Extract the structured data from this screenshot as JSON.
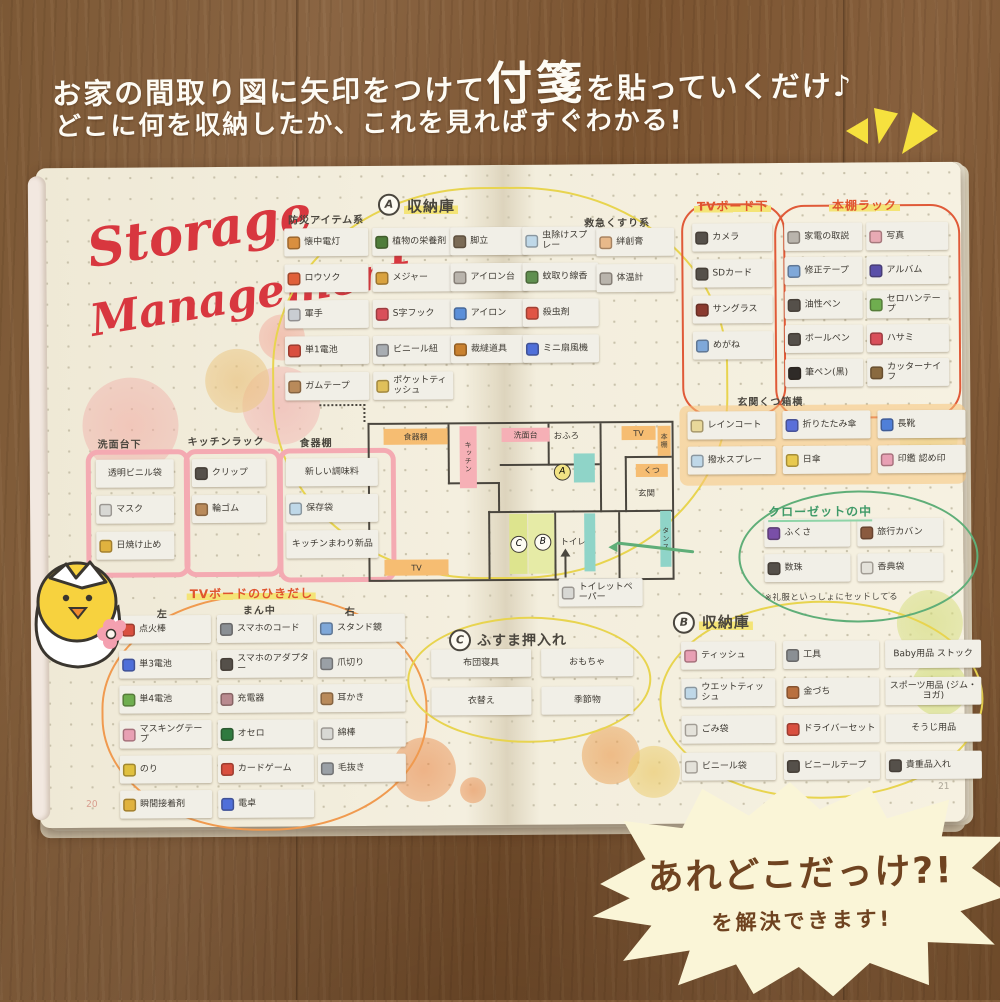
{
  "intro": {
    "line1_pre": "お家の間取り図に矢印をつけて",
    "line1_big": "付箋",
    "line1_post": "を貼っていくだけ♪",
    "line2": "どこに何を収納したか、これを見ればすぐわかる!"
  },
  "burst": {
    "line1": "あれどこだっけ?!",
    "line2": "を解決できます!"
  },
  "notebook": {
    "title": {
      "line1": "Storage",
      "line2": "Management"
    },
    "page_numbers": {
      "left": "20",
      "right": "21"
    },
    "floorplan": {
      "shokkidana": "食器棚",
      "kitchen": "キッチン",
      "senmendai": "洗面台",
      "ofuro": "おふろ",
      "tv_top": "TV",
      "hondana": "本棚",
      "kutsu": "くつ",
      "genkan": "玄関",
      "tansu": "タンス",
      "toilet": "トイレ",
      "tv_bottom": "TV",
      "badge_a": "A",
      "badge_b": "B",
      "badge_c": "C"
    },
    "sections": {
      "bousai": {
        "title": "防災アイテム系",
        "items": [
          {
            "label": "懐中電灯",
            "icon": "flashlight-icon",
            "color": "#d98f3f"
          },
          {
            "label": "ロウソク",
            "icon": "candle-icon",
            "color": "#e0603a"
          },
          {
            "label": "軍手",
            "icon": "glove-icon",
            "color": "#c9cdd2"
          },
          {
            "label": "単1電池",
            "icon": "battery-icon",
            "color": "#d94f3f"
          },
          {
            "label": "ガムテープ",
            "icon": "tape-roll-icon",
            "color": "#b98a5a"
          }
        ]
      },
      "storage_a": {
        "badge": "A",
        "title": "収納庫",
        "col1_items": [
          {
            "label": "植物の栄養剤",
            "icon": "plant-nutrient-icon",
            "color": "#4f7d3a"
          },
          {
            "label": "メジャー",
            "icon": "measuring-tape-icon",
            "color": "#d9a23f"
          },
          {
            "label": "S字フック",
            "icon": "s-hook-icon",
            "color": "#d94f5a"
          },
          {
            "label": "ビニール紐",
            "icon": "vinyl-string-icon",
            "color": "#a8adb2"
          },
          {
            "label": "ポケットティッシュ",
            "icon": "pocket-tissue-icon",
            "color": "#e0c05a"
          }
        ],
        "col2_items": [
          {
            "label": "脚立",
            "icon": "stepladder-icon",
            "color": "#7a6a55"
          },
          {
            "label": "アイロン台",
            "icon": "ironing-board-icon",
            "color": "#b9b4ac"
          },
          {
            "label": "アイロン",
            "icon": "iron-icon",
            "color": "#5b8fd9"
          },
          {
            "label": "裁縫道具",
            "icon": "sewing-kit-icon",
            "color": "#c9812f"
          }
        ]
      },
      "mushi": {
        "items": [
          {
            "label": "虫除けスプレー",
            "icon": "bug-spray-icon",
            "color": "#bfd8e8"
          },
          {
            "label": "蚊取り線香",
            "icon": "mosquito-coil-icon",
            "color": "#5f8f4f"
          },
          {
            "label": "殺虫剤",
            "icon": "insecticide-icon",
            "color": "#e05545"
          },
          {
            "label": "ミニ扇風機",
            "icon": "mini-fan-icon",
            "color": "#4f6fd9"
          }
        ]
      },
      "kyukyu": {
        "title": "救急くすり系",
        "items": [
          {
            "label": "絆創膏",
            "icon": "bandage-icon",
            "color": "#e8b98a"
          },
          {
            "label": "体温計",
            "icon": "thermometer-icon",
            "color": "#b9b4ac"
          }
        ]
      },
      "tvboard_shita": {
        "title": "TVボード下",
        "items": [
          {
            "label": "カメラ",
            "icon": "camera-icon",
            "color": "#55504a"
          },
          {
            "label": "SDカード",
            "icon": "sd-card-icon",
            "color": "#55504a"
          },
          {
            "label": "サングラス",
            "icon": "sunglasses-icon",
            "color": "#8a3a2f"
          },
          {
            "label": "めがね",
            "icon": "glasses-icon",
            "color": "#7fa8d9"
          }
        ]
      },
      "hondana_rack": {
        "title": "本棚ラック",
        "col1_items": [
          {
            "label": "家電の取説",
            "icon": "manual-icon",
            "color": "#b9b4ac"
          },
          {
            "label": "修正テープ",
            "icon": "correction-tape-icon",
            "color": "#7fa8d9"
          },
          {
            "label": "油性ペン",
            "icon": "permanent-marker-icon",
            "color": "#55504a"
          },
          {
            "label": "ボールペン",
            "icon": "ballpoint-pen-icon",
            "color": "#55504a"
          },
          {
            "label": "筆ペン(黒)",
            "icon": "brush-pen-icon",
            "color": "#2f2b28"
          }
        ],
        "col2_items": [
          {
            "label": "写真",
            "icon": "photo-icon",
            "color": "#e8aab4"
          },
          {
            "label": "アルバム",
            "icon": "album-icon",
            "color": "#5a4fa8"
          },
          {
            "label": "セロハンテープ",
            "icon": "cellophane-tape-icon",
            "color": "#6fae4f"
          },
          {
            "label": "ハサミ",
            "icon": "scissors-icon",
            "color": "#d94f5a"
          },
          {
            "label": "カッターナイフ",
            "icon": "cutter-knife-icon",
            "color": "#8a6a3f"
          }
        ]
      },
      "senmendai_shita": {
        "title": "洗面台下",
        "items": [
          {
            "label": "透明ビニル袋",
            "icon": null,
            "color": null
          },
          {
            "label": "マスク",
            "icon": "mask-icon",
            "color": "#d8d8d4"
          },
          {
            "label": "日焼け止め",
            "icon": "sunscreen-icon",
            "color": "#e0b23f"
          }
        ]
      },
      "kitchen_rack": {
        "title": "キッチンラック",
        "items": [
          {
            "label": "クリップ",
            "icon": "clip-icon",
            "color": "#55504a"
          },
          {
            "label": "輪ゴム",
            "icon": "rubber-band-icon",
            "color": "#b98a5a"
          }
        ]
      },
      "shokkidana": {
        "title": "食器棚",
        "items": [
          {
            "label": "新しい調味料",
            "icon": null,
            "color": null
          },
          {
            "label": "保存袋",
            "icon": "storage-bag-icon",
            "color": "#bfd8e8"
          },
          {
            "label": "キッチンまわり新品",
            "icon": null,
            "color": null
          }
        ]
      },
      "genkan_kutsubako": {
        "title": "玄関くつ箱横",
        "items": [
          {
            "label": "レインコート",
            "icon": "raincoat-icon",
            "color": "#e8d89a"
          },
          {
            "label": "折りたたみ傘",
            "icon": "folding-umbrella-icon",
            "color": "#5a6fd9"
          },
          {
            "label": "長靴",
            "icon": "rain-boots-icon",
            "color": "#4f7fd9"
          },
          {
            "label": "撥水スプレー",
            "icon": "water-repellent-spray-icon",
            "color": "#bfd8e8"
          },
          {
            "label": "日傘",
            "icon": "parasol-icon",
            "color": "#e8c94f"
          },
          {
            "label": "印鑑 認め印",
            "icon": "seal-stamp-icon",
            "color": "#e8a0b4"
          }
        ]
      },
      "closet": {
        "title": "クローゼットの中",
        "note": "※礼服といっしょにセットしてる",
        "items": [
          {
            "label": "ふくさ",
            "icon": "fukusa-icon",
            "color": "#7a4fa8"
          },
          {
            "label": "旅行カバン",
            "icon": "travel-bag-icon",
            "color": "#8a5a3f"
          },
          {
            "label": "数珠",
            "icon": "prayer-beads-icon",
            "color": "#55504a"
          },
          {
            "label": "香典袋",
            "icon": "condolence-envelope-icon",
            "color": "#e4e2da"
          }
        ]
      },
      "tv_drawer": {
        "title": "TVボードのひきだし",
        "col_left_title": "左",
        "col_mid_title": "まん中",
        "col_right_title": "右",
        "left_items": [
          {
            "label": "点火棒",
            "icon": "lighter-icon",
            "color": "#d94f3f"
          },
          {
            "label": "単3電池",
            "icon": "aa-battery-icon",
            "color": "#4f6fd9"
          },
          {
            "label": "単4電池",
            "icon": "aaa-battery-icon",
            "color": "#6fae4f"
          },
          {
            "label": "マスキングテープ",
            "icon": "masking-tape-icon",
            "color": "#e8a0b4"
          },
          {
            "label": "のり",
            "icon": "glue-icon",
            "color": "#e0c03f"
          },
          {
            "label": "瞬間接着剤",
            "icon": "super-glue-icon",
            "color": "#e0b23f"
          }
        ],
        "mid_items": [
          {
            "label": "スマホのコード",
            "icon": "phone-cord-icon",
            "color": "#8a8f94"
          },
          {
            "label": "スマホのアダプター",
            "icon": "phone-adapter-icon",
            "color": "#55504a"
          },
          {
            "label": "充電器",
            "icon": "charger-icon",
            "color": "#b98a8f"
          },
          {
            "label": "オセロ",
            "icon": "othello-icon",
            "color": "#2f7a3f"
          },
          {
            "label": "カードゲーム",
            "icon": "card-game-icon",
            "color": "#d94f3f"
          },
          {
            "label": "電卓",
            "icon": "calculator-icon",
            "color": "#4f6fd9"
          }
        ],
        "right_items": [
          {
            "label": "スタンド鏡",
            "icon": "stand-mirror-icon",
            "color": "#7fa8d9"
          },
          {
            "label": "爪切り",
            "icon": "nail-clipper-icon",
            "color": "#9aa0a6"
          },
          {
            "label": "耳かき",
            "icon": "ear-pick-icon",
            "color": "#b98a5a"
          },
          {
            "label": "綿棒",
            "icon": "cotton-swab-icon",
            "color": "#d8d8d4"
          },
          {
            "label": "毛抜き",
            "icon": "tweezers-icon",
            "color": "#9aa0a6"
          }
        ]
      },
      "fusuma": {
        "badge": "C",
        "title": "ふすま押入れ",
        "items": [
          {
            "label": "布団寝具",
            "icon": null,
            "color": null
          },
          {
            "label": "おもちゃ",
            "icon": null,
            "color": null
          },
          {
            "label": "衣替え",
            "icon": null,
            "color": null
          },
          {
            "label": "季節物",
            "icon": null,
            "color": null
          }
        ]
      },
      "toilet_paper": {
        "items": [
          {
            "label": "トイレットペーパー",
            "icon": "toilet-paper-icon",
            "color": "#d8d8d4"
          }
        ]
      },
      "storage_b": {
        "badge": "B",
        "title": "収納庫",
        "col1_items": [
          {
            "label": "ティッシュ",
            "icon": "tissue-box-icon",
            "color": "#e8a0b4"
          },
          {
            "label": "ウエットティッシュ",
            "icon": "wet-tissue-icon",
            "color": "#bfd8e8"
          },
          {
            "label": "ごみ袋",
            "icon": "garbage-bag-icon",
            "color": "#e4e2da"
          },
          {
            "label": "ビニール袋",
            "icon": "plastic-bag-icon",
            "color": "#e4e2da"
          }
        ],
        "col2_items": [
          {
            "label": "工具",
            "icon": "tools-icon",
            "color": "#8a8f94"
          },
          {
            "label": "金づち",
            "icon": "hammer-icon",
            "color": "#b9703f"
          },
          {
            "label": "ドライバーセット",
            "icon": "screwdriver-set-icon",
            "color": "#d94f3f"
          },
          {
            "label": "ビニールテープ",
            "icon": "vinyl-tape-icon",
            "color": "#55504a"
          }
        ],
        "col3_items": [
          {
            "label": "Baby用品 ストック",
            "icon": null,
            "color": null
          },
          {
            "label": "スポーツ用品 (ジム・ヨガ)",
            "icon": null,
            "color": null
          },
          {
            "label": "そうじ用品",
            "icon": null,
            "color": null
          },
          {
            "label": "貴重品入れ",
            "icon": "valuables-book-icon",
            "color": "#55504a"
          }
        ]
      }
    }
  },
  "palette": {
    "red_script": "#d8373f",
    "ink": "#4a463e",
    "loop_red": "#e05a38",
    "loop_yellow": "#e8d44f",
    "loop_orange": "#f09a4f",
    "loop_green": "#5fae78",
    "marker_pink": "#f4aab2",
    "marker_orange": "#f6bd72",
    "burst_bg": "#faf5d7",
    "burst_text": "#6f4320"
  }
}
